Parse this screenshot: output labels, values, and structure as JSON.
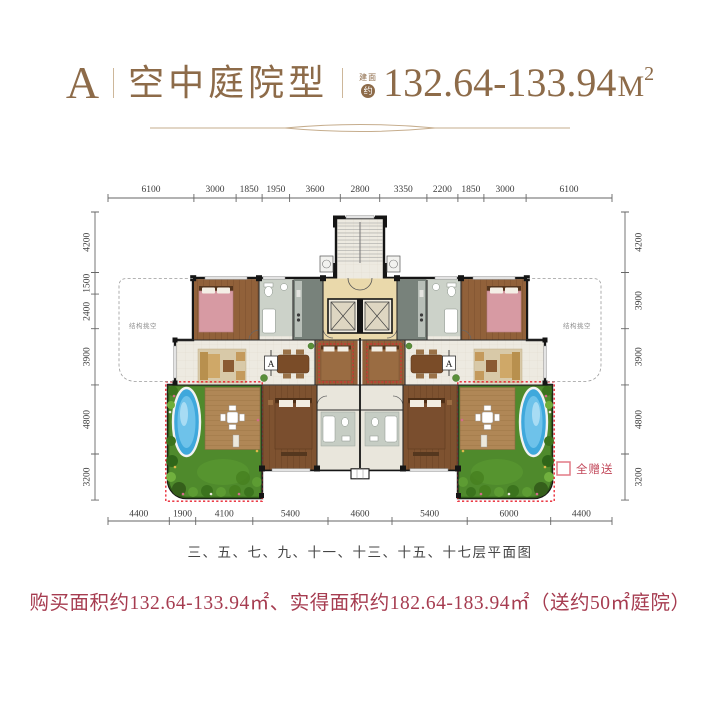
{
  "header": {
    "unit_letter": "A",
    "unit_type": "空中庭院型",
    "area_prefix_small": "建面",
    "area_prefix_circle": "约",
    "area_value": "132.64-133.94",
    "area_unit": "M",
    "area_sup": "2"
  },
  "plan": {
    "dims_top": [
      "6100",
      "3000",
      "1850",
      "1950",
      "3600",
      "2800",
      "3350",
      "2200",
      "1850",
      "3000",
      "6100"
    ],
    "dims_bottom": [
      "4400",
      "1900",
      "4100",
      "5400",
      "4600",
      "5400",
      "6000",
      "4400"
    ],
    "dims_left": [
      "4200",
      "1500",
      "2400",
      "3900",
      "4800",
      "3200"
    ],
    "dims_right": [
      "4200",
      "3900",
      "3900",
      "4800",
      "3200"
    ],
    "void_label_left": "结构挑空",
    "void_label_right": "结构挑空",
    "section_marker": "A",
    "legend_label": "全赠送"
  },
  "caption": "三、五、七、九、十一、十三、十五、十七层平面图",
  "footer_note": "购买面积约132.64-133.94㎡、实得面积约182.64-183.94㎡（送约50㎡庭院）",
  "colors": {
    "brand_bronze": "#8d6b49",
    "note_red": "#a63c50",
    "gift_outline_red": "#e8212e",
    "lawn_green": "#4f8a2c",
    "pool_blue": "#3fa8dc",
    "wood_brown": "#8a5c34"
  }
}
